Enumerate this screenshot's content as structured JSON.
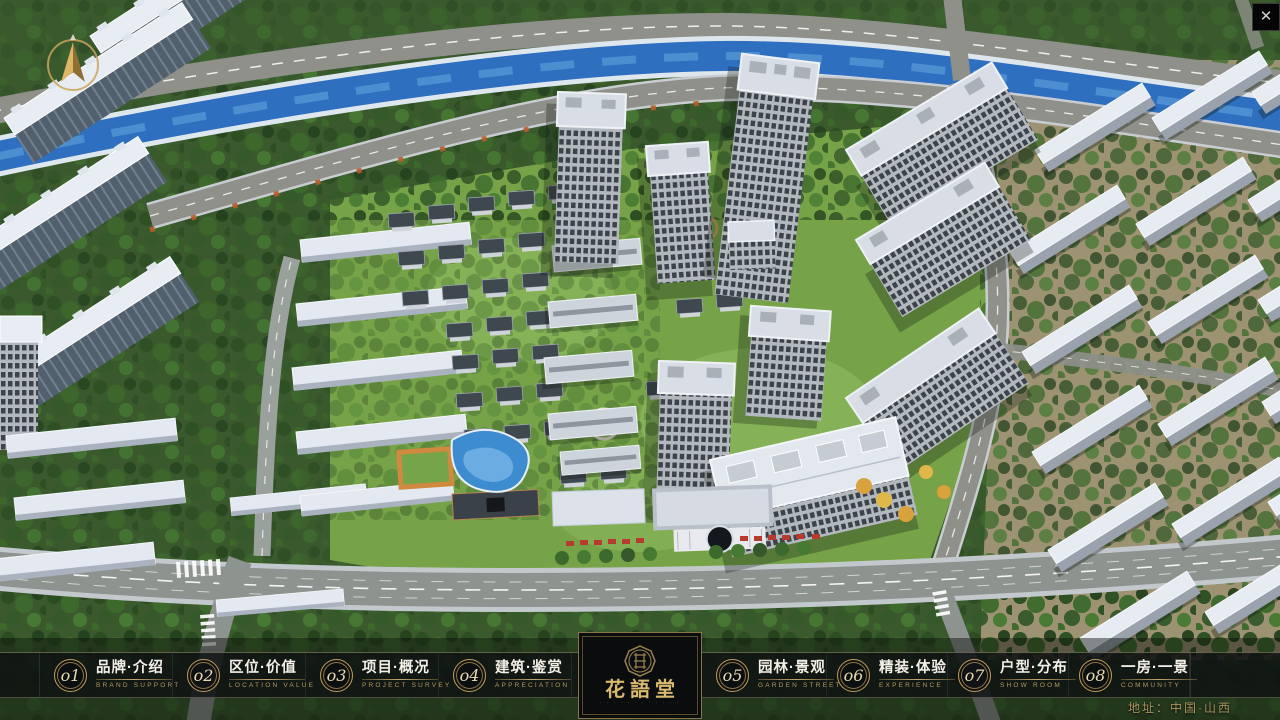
{
  "window": {
    "close_label": "✕"
  },
  "nav": {
    "items_left": [
      {
        "num": "o1",
        "zh": "品牌·介绍",
        "en": "BRAND SUPPORT"
      },
      {
        "num": "o2",
        "zh": "区位·价值",
        "en": "LOCATION VALUE"
      },
      {
        "num": "o3",
        "zh": "项目·概况",
        "en": "PROJECT SURVEY"
      },
      {
        "num": "o4",
        "zh": "建筑·鉴赏",
        "en": "APPRECIATION"
      }
    ],
    "items_right": [
      {
        "num": "o5",
        "zh": "园林·景观",
        "en": "GARDEN STREET"
      },
      {
        "num": "o6",
        "zh": "精装·体验",
        "en": "EXPERIENCE"
      },
      {
        "num": "o7",
        "zh": "户型·分布",
        "en": "SHOW ROOM"
      },
      {
        "num": "o8",
        "zh": "一房·一景",
        "en": "COMMUNITY"
      }
    ]
  },
  "logo": {
    "title": "花語堂",
    "subtitle": "· · · · · · · · · · · ·"
  },
  "footer": {
    "address": "地址：中国·山西"
  },
  "colors": {
    "gold": "#c0a269",
    "nav_bg": "rgba(14,16,18,0.78)",
    "river": "#2e6fc0",
    "lawn": "#76a348"
  }
}
